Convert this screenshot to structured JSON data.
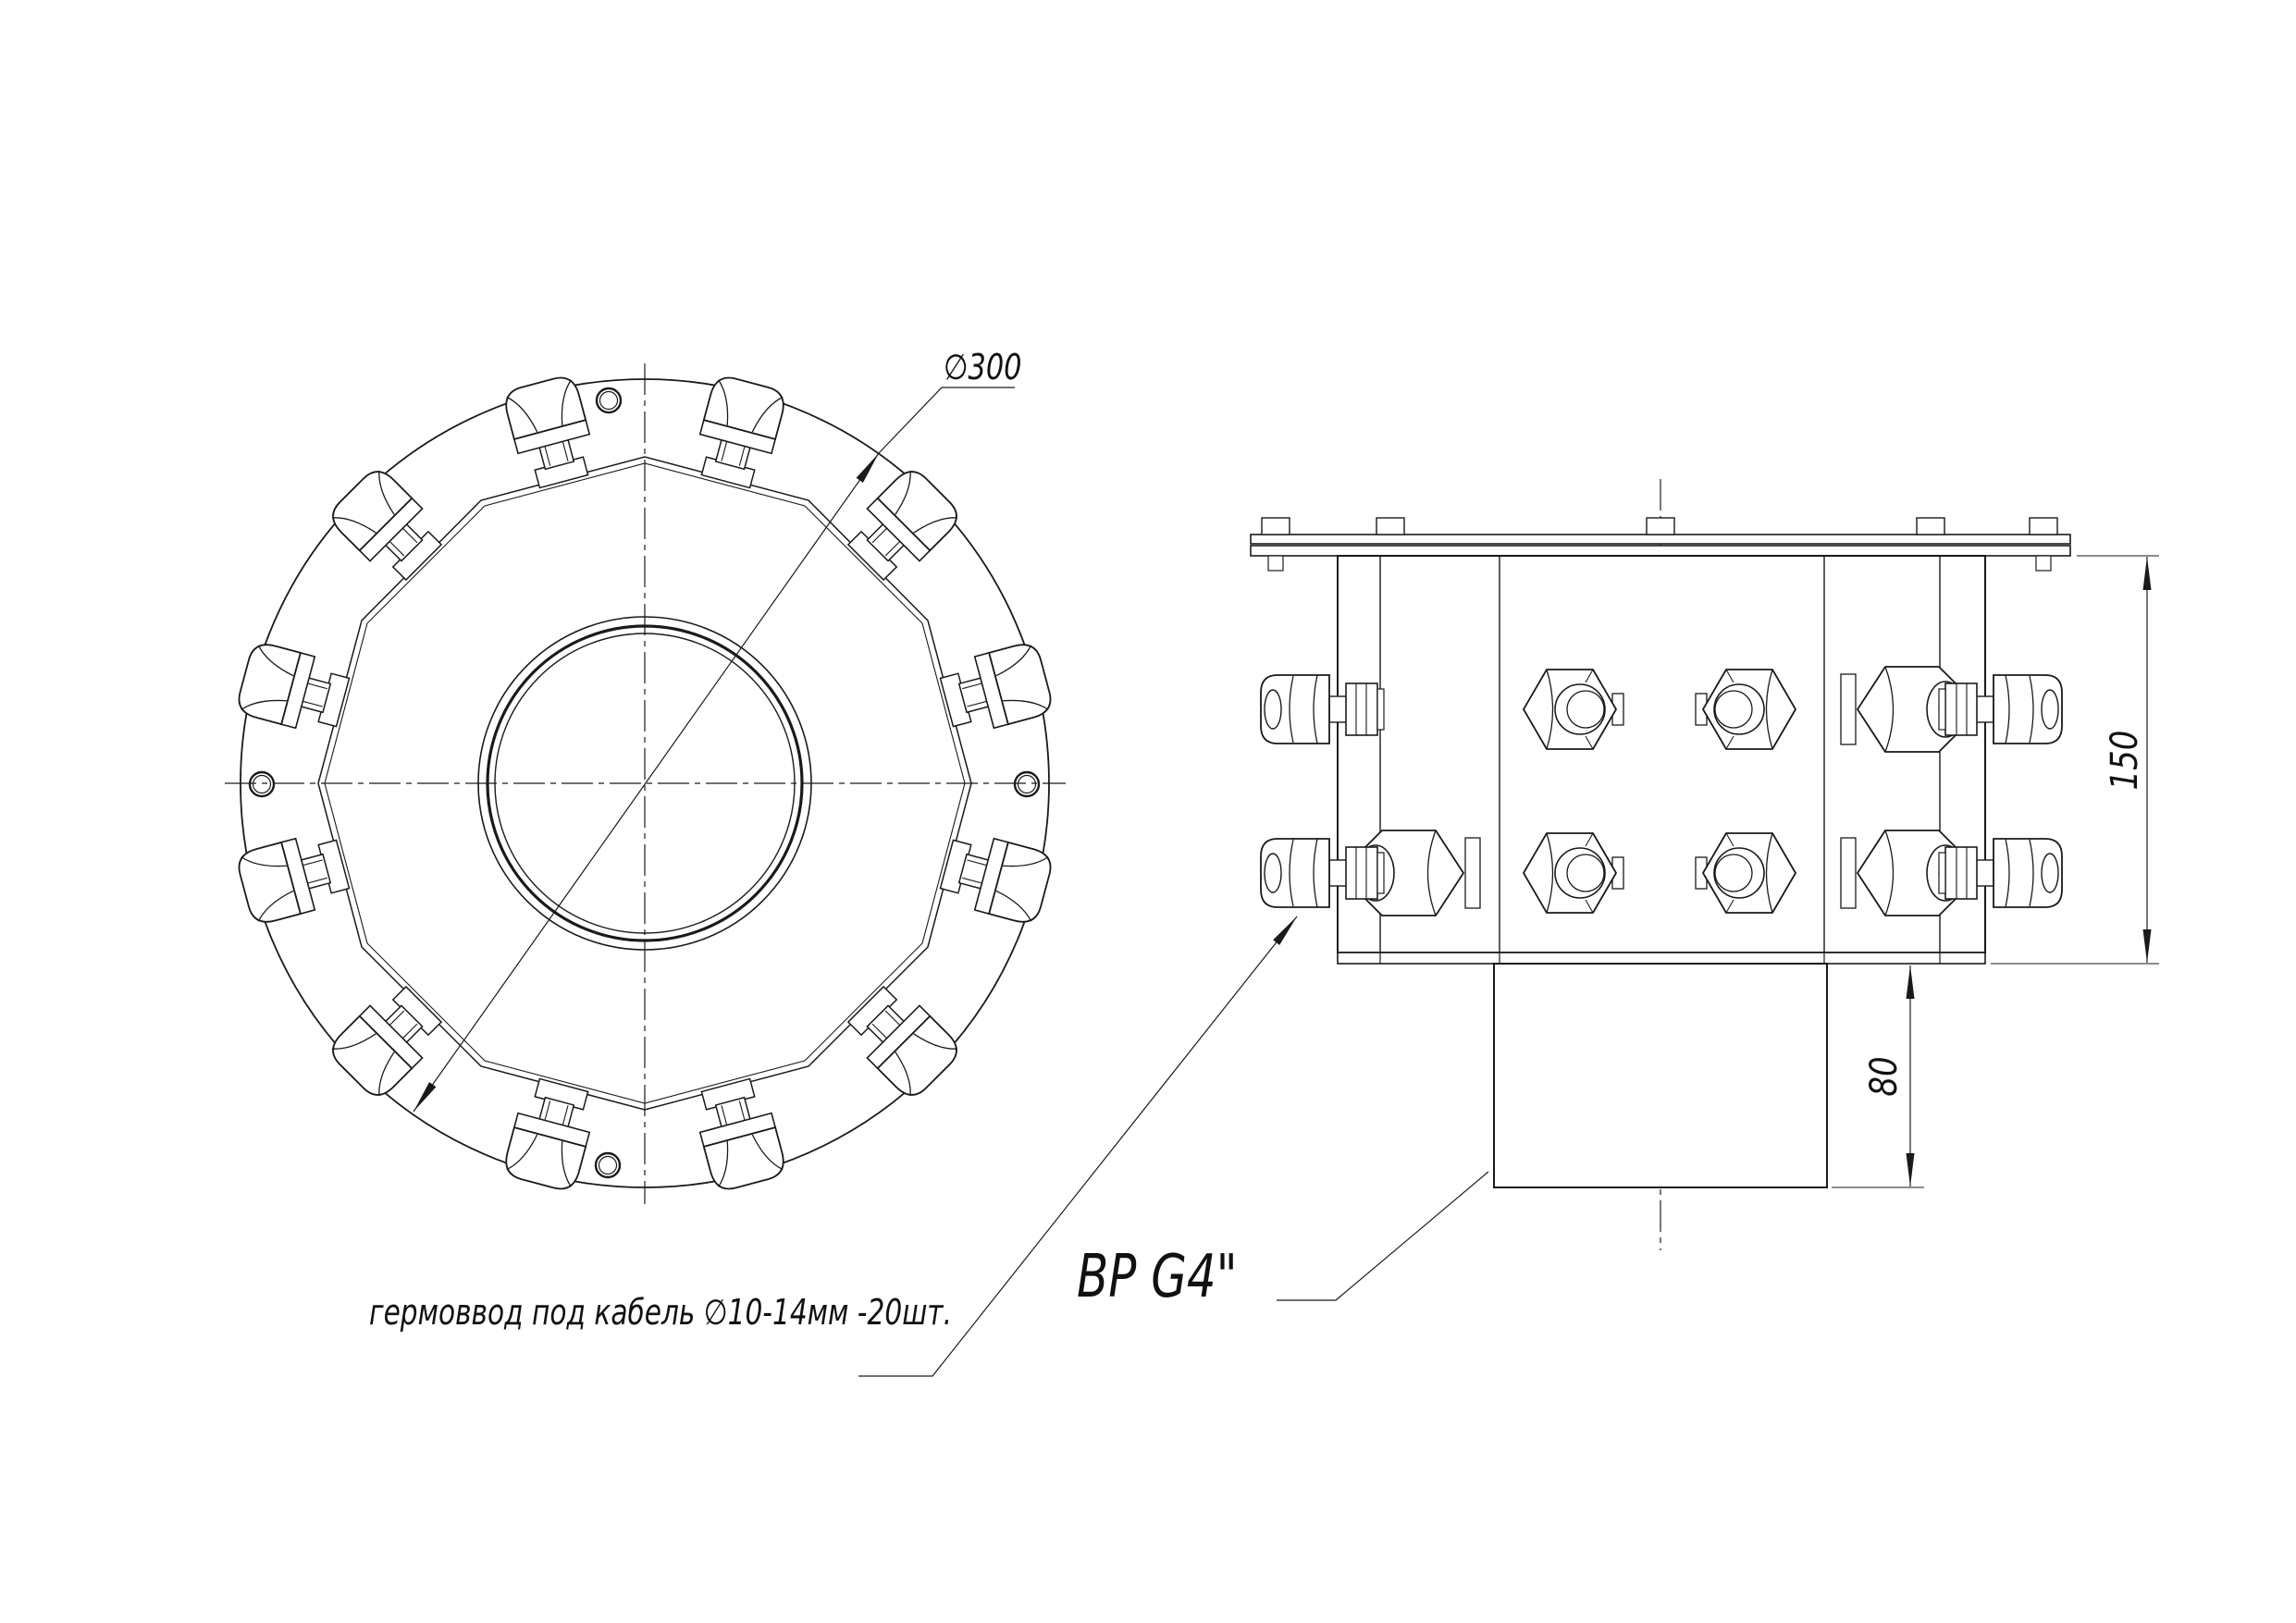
{
  "labels": {
    "diameter": "∅300",
    "overall_height": "150",
    "spigot_height": "80",
    "thread_note": "ВР G4\"",
    "gland_note": "гермоввод под кабель ∅10-14мм  -20шт."
  },
  "colors": {
    "background": "#ffffff",
    "line": "#1a1a1a"
  }
}
